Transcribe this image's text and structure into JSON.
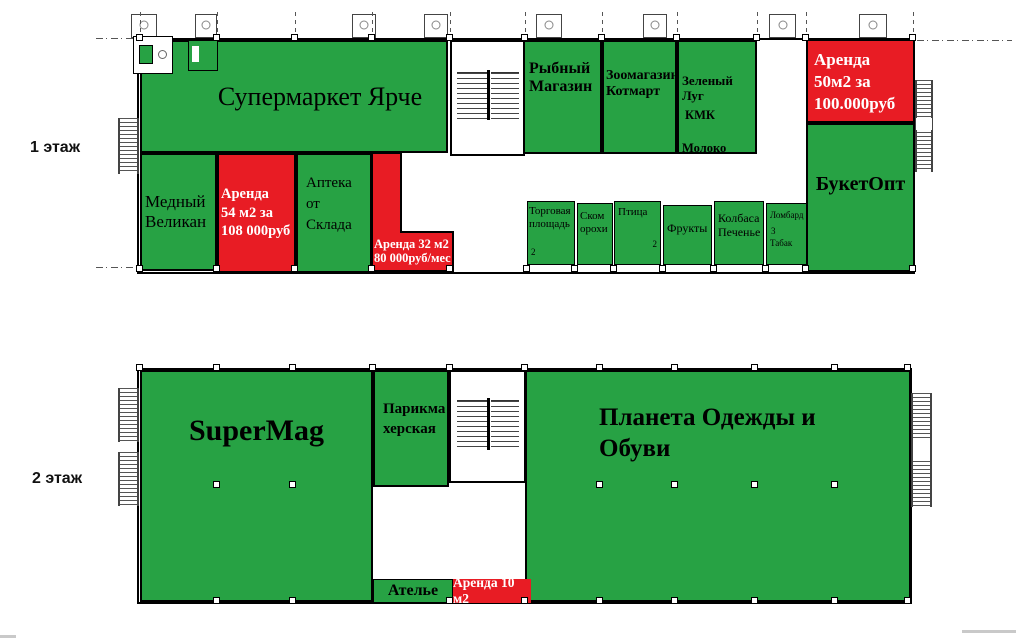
{
  "colors": {
    "occupied_green": "#27a244",
    "vacant_red": "#e81c24",
    "wall_black": "#000000"
  },
  "floor1": {
    "floor_label": "1 этаж",
    "rooms": {
      "supermarket": "Супермаркет Ярче",
      "medny_velikan": "Медный\nВеликан",
      "rent_54": "Аренда\n54 м2 за\n108 000руб",
      "apteka": "Аптека\nот\nСклада",
      "rent_32": "Аренда 32 м2\n80 000руб/мес",
      "rybny_magazin": "Рыбный\nМагазин",
      "zoomagazin_kotmart": "Зоомагазин\nКотмарт",
      "zeleny_lug": "Зеленый Луг",
      "kmk": "КМК",
      "moloko": "Молоко",
      "rent_50": "Аренда\n50м2 за\n100.000руб",
      "buket_opt": "БукетОпт",
      "torgovaya_ploshchad": "Торговая\nплощадь",
      "torgovaya_num": "2",
      "skom_orohi": "Ском\nорохи",
      "ptitsa": "Птица",
      "ptitsa_num": "2",
      "frukty": "Фрукты",
      "kolbasa_pechenye": "Колбаса\nПеченье",
      "lombard": "Ломбард",
      "lombard_num": "3",
      "tabak": "Табак"
    }
  },
  "floor2": {
    "floor_label": "2 этаж",
    "rooms": {
      "supermag": "SuperMag",
      "parikmakherskaya": "Парикма\nхерская",
      "planeta": "Планета Одежды и\nОбуви",
      "atelye": "Ателье",
      "rent_10": "Аренда 10 м2"
    }
  }
}
